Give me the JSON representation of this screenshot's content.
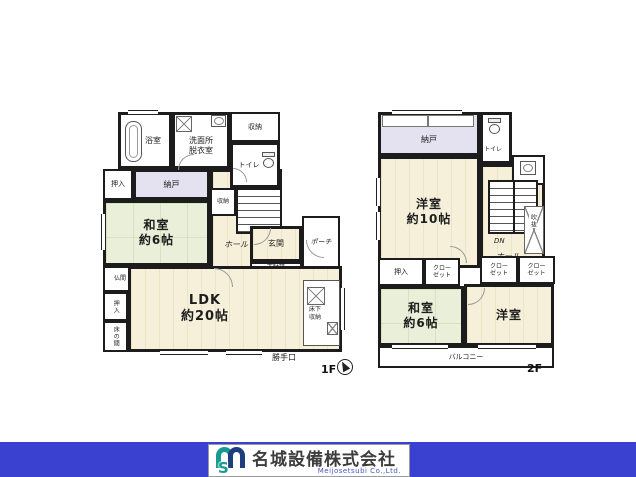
{
  "colors": {
    "wall": "#1c1c1c",
    "wood_floor": "#f6f0da",
    "tatami_green": "#e9efd8",
    "closet_purple": "#e4e2f0",
    "footer_blue": "#3a41d0",
    "logo_teal": "#179a94",
    "logo_navy": "#1d3e7e"
  },
  "f1": {
    "floor_label": "1F",
    "rooms": {
      "bath": "浴室",
      "washroom": "洗面所\n脱衣室",
      "storage_top": "収納",
      "toilet": "トイレ",
      "oshiire_up": "押入",
      "nando": "納戸",
      "washitsu": "和室\n約6帖",
      "hall": "ホール",
      "storage_stairs": "収納",
      "stairs_up": "UP",
      "genkan": "玄関",
      "getabako": "下駄箱",
      "porch": "ポーチ",
      "butsuma": "仏間",
      "oshiire_side": "押入",
      "tokonoma": "床の間",
      "ldk": "LDK\n約20帖",
      "yukashita": "床下\n収納",
      "katteguchi": "勝手口"
    }
  },
  "f2": {
    "floor_label": "2F",
    "rooms": {
      "nando": "納戸",
      "toilet": "トイレ",
      "youshitsu10": "洋室\n約10帖",
      "stairs_down": "DN",
      "fukinuke": "吹抜",
      "hall": "ホール",
      "oshiire": "押入",
      "closet_a": "クロー\nゼット",
      "closet_b": "クロー\nゼット",
      "closet_c": "クロー\nゼット",
      "washitsu6": "和室\n約6帖",
      "youshitsu": "洋室",
      "balcony": "バルコニー"
    }
  },
  "footer": {
    "company_name": "名城設備株式会社",
    "company_name_en": "Meijosetsubi Co.,Ltd.",
    "logo_s": "S"
  }
}
